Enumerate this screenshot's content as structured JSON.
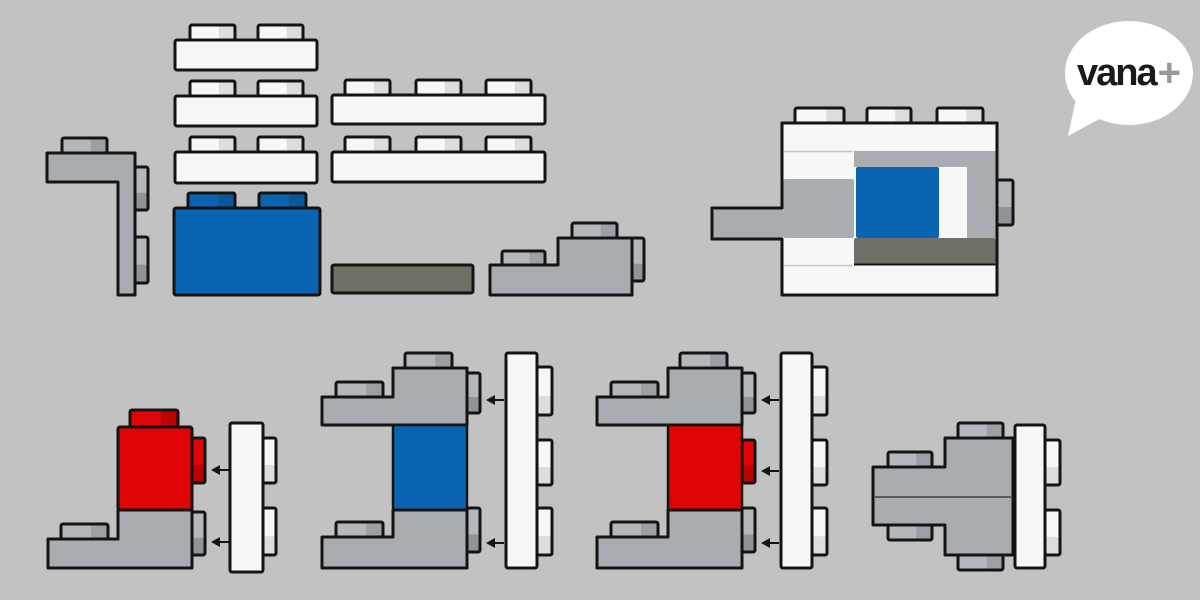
{
  "logo": {
    "brand": "vana",
    "plus": "+"
  },
  "colors": {
    "background": "#C2C2C2",
    "outline": "#141414",
    "gray_body": "#A9ADB2",
    "gray_stud": "#B4B8BC",
    "gray_stud_shade": "#9BA0A6",
    "gray_side_shade": "#8E9499",
    "white_body": "#F7F7F7",
    "white_stud_shade": "#DDDDDD",
    "blue": "#0A64B2",
    "blue_shade": "#0B569C",
    "red": "#DF0505",
    "red_shade": "#BA0404",
    "olive": "#6F7067",
    "hairline": "#C6C6C6",
    "seam": "#575C61",
    "logo_bubble": "#FFFFFF",
    "logo_text": "#1A1A1A",
    "logo_plus": "#97999B"
  },
  "pieces": {
    "parts_tray": [
      "gray-corner-brick",
      "white-brick-2stud-1",
      "white-brick-2stud-2",
      "white-brick-2stud-3",
      "white-brick-3stud-1",
      "white-brick-3stud-2",
      "blue-brick",
      "olive-plate",
      "gray-step-brick"
    ],
    "assembled_preview": "assembly-top-right",
    "steps": [
      "step1-red-brick-with-gray-corner-and-white-brick",
      "step2-blue-brick-between-gray-corners-and-white-brick",
      "step3-red-brick-between-gray-corners-and-white-brick",
      "final-assembly"
    ],
    "arrow_counts": {
      "step1": 2,
      "step2": 2,
      "step3": 3
    }
  }
}
